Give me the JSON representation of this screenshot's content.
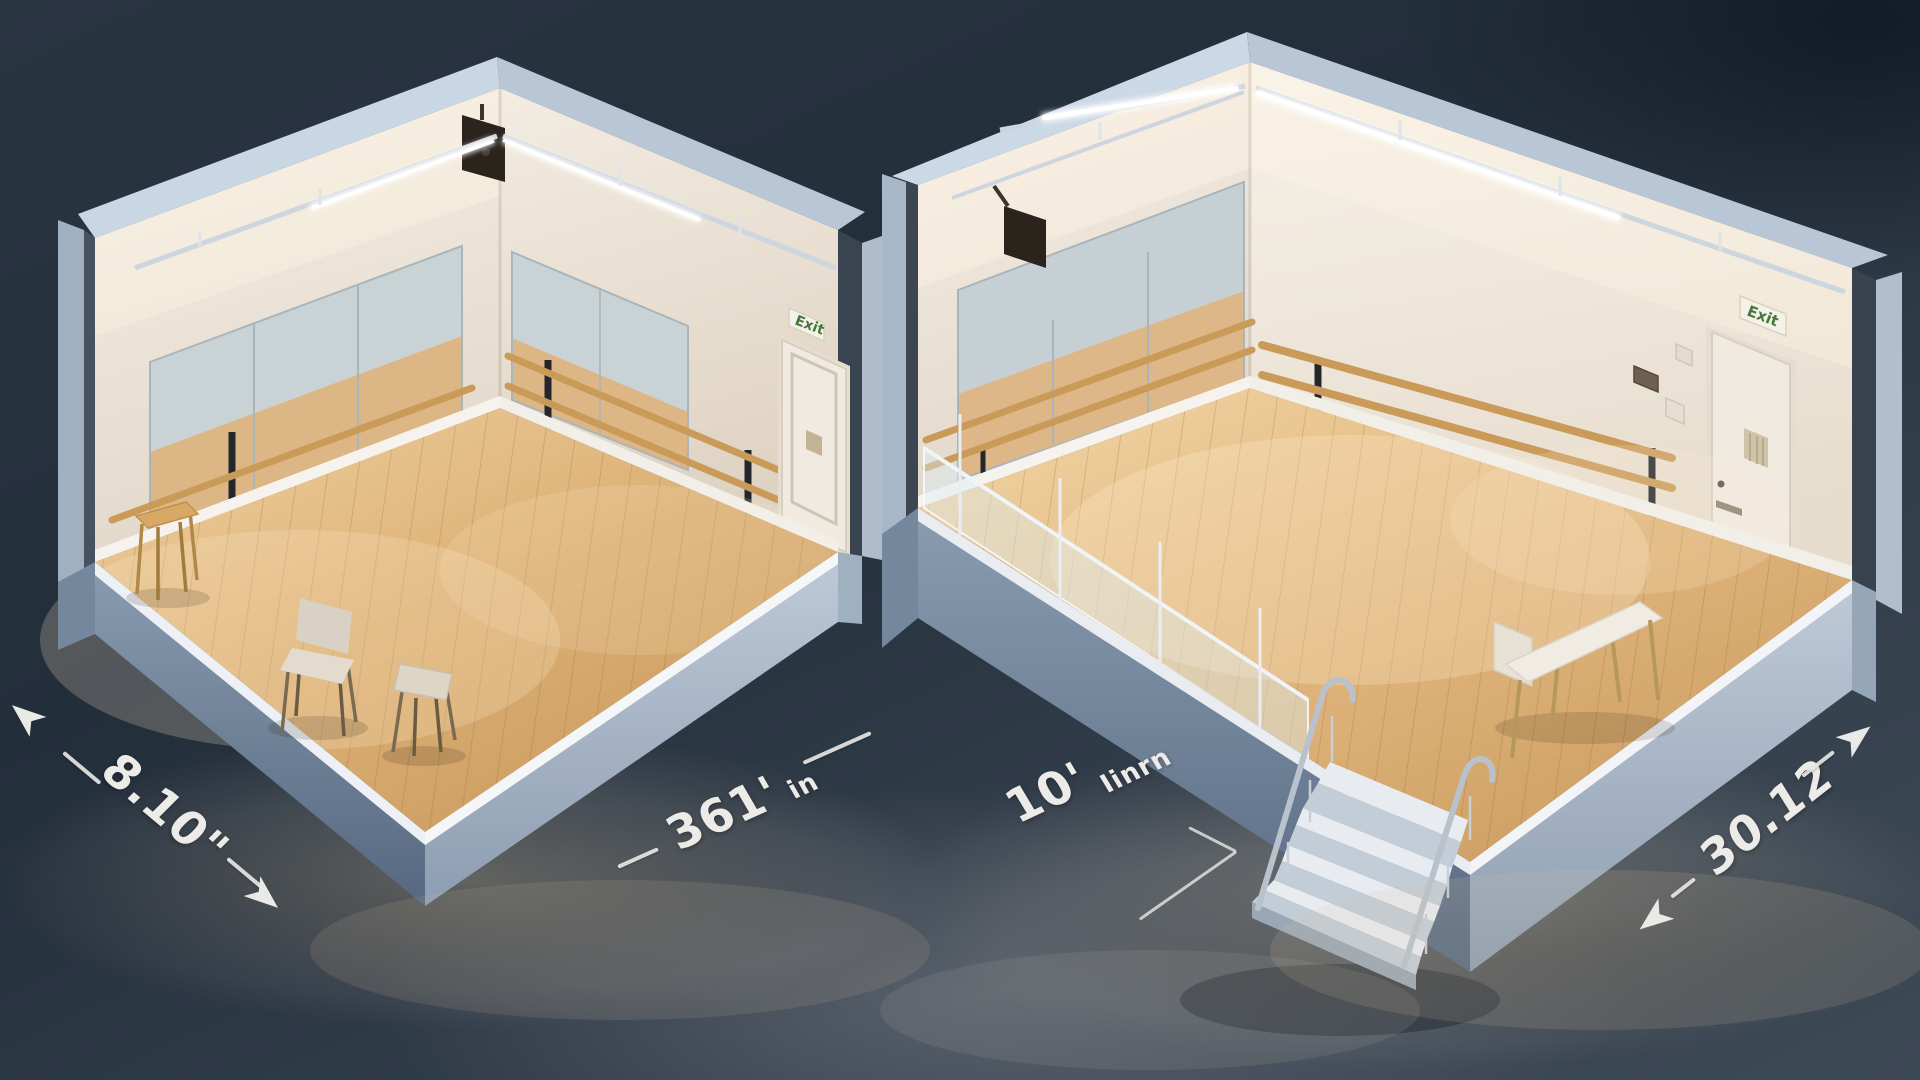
{
  "annotations": {
    "left_room_width": "8.10\"",
    "left_room_depth_value": "361'",
    "left_room_depth_unit": "in",
    "center_value": "10'",
    "center_unit": "Iinrn",
    "right_room_depth": "30.12"
  },
  "rooms": {
    "left": {
      "exit_sign_label": "Exit"
    },
    "right": {
      "exit_sign_label": "Exit"
    }
  },
  "colors": {
    "background": "#2a3542",
    "shell_light": "#c9d6e4",
    "shell_mid": "#9fb0c2",
    "wall_white": "#efe8df",
    "floor_wood": "#ddb177",
    "barre_wood": "#c99a58",
    "mirror": "#c9d3d6",
    "exit_green": "#47763b",
    "dimension_text": "#ecebe7"
  }
}
